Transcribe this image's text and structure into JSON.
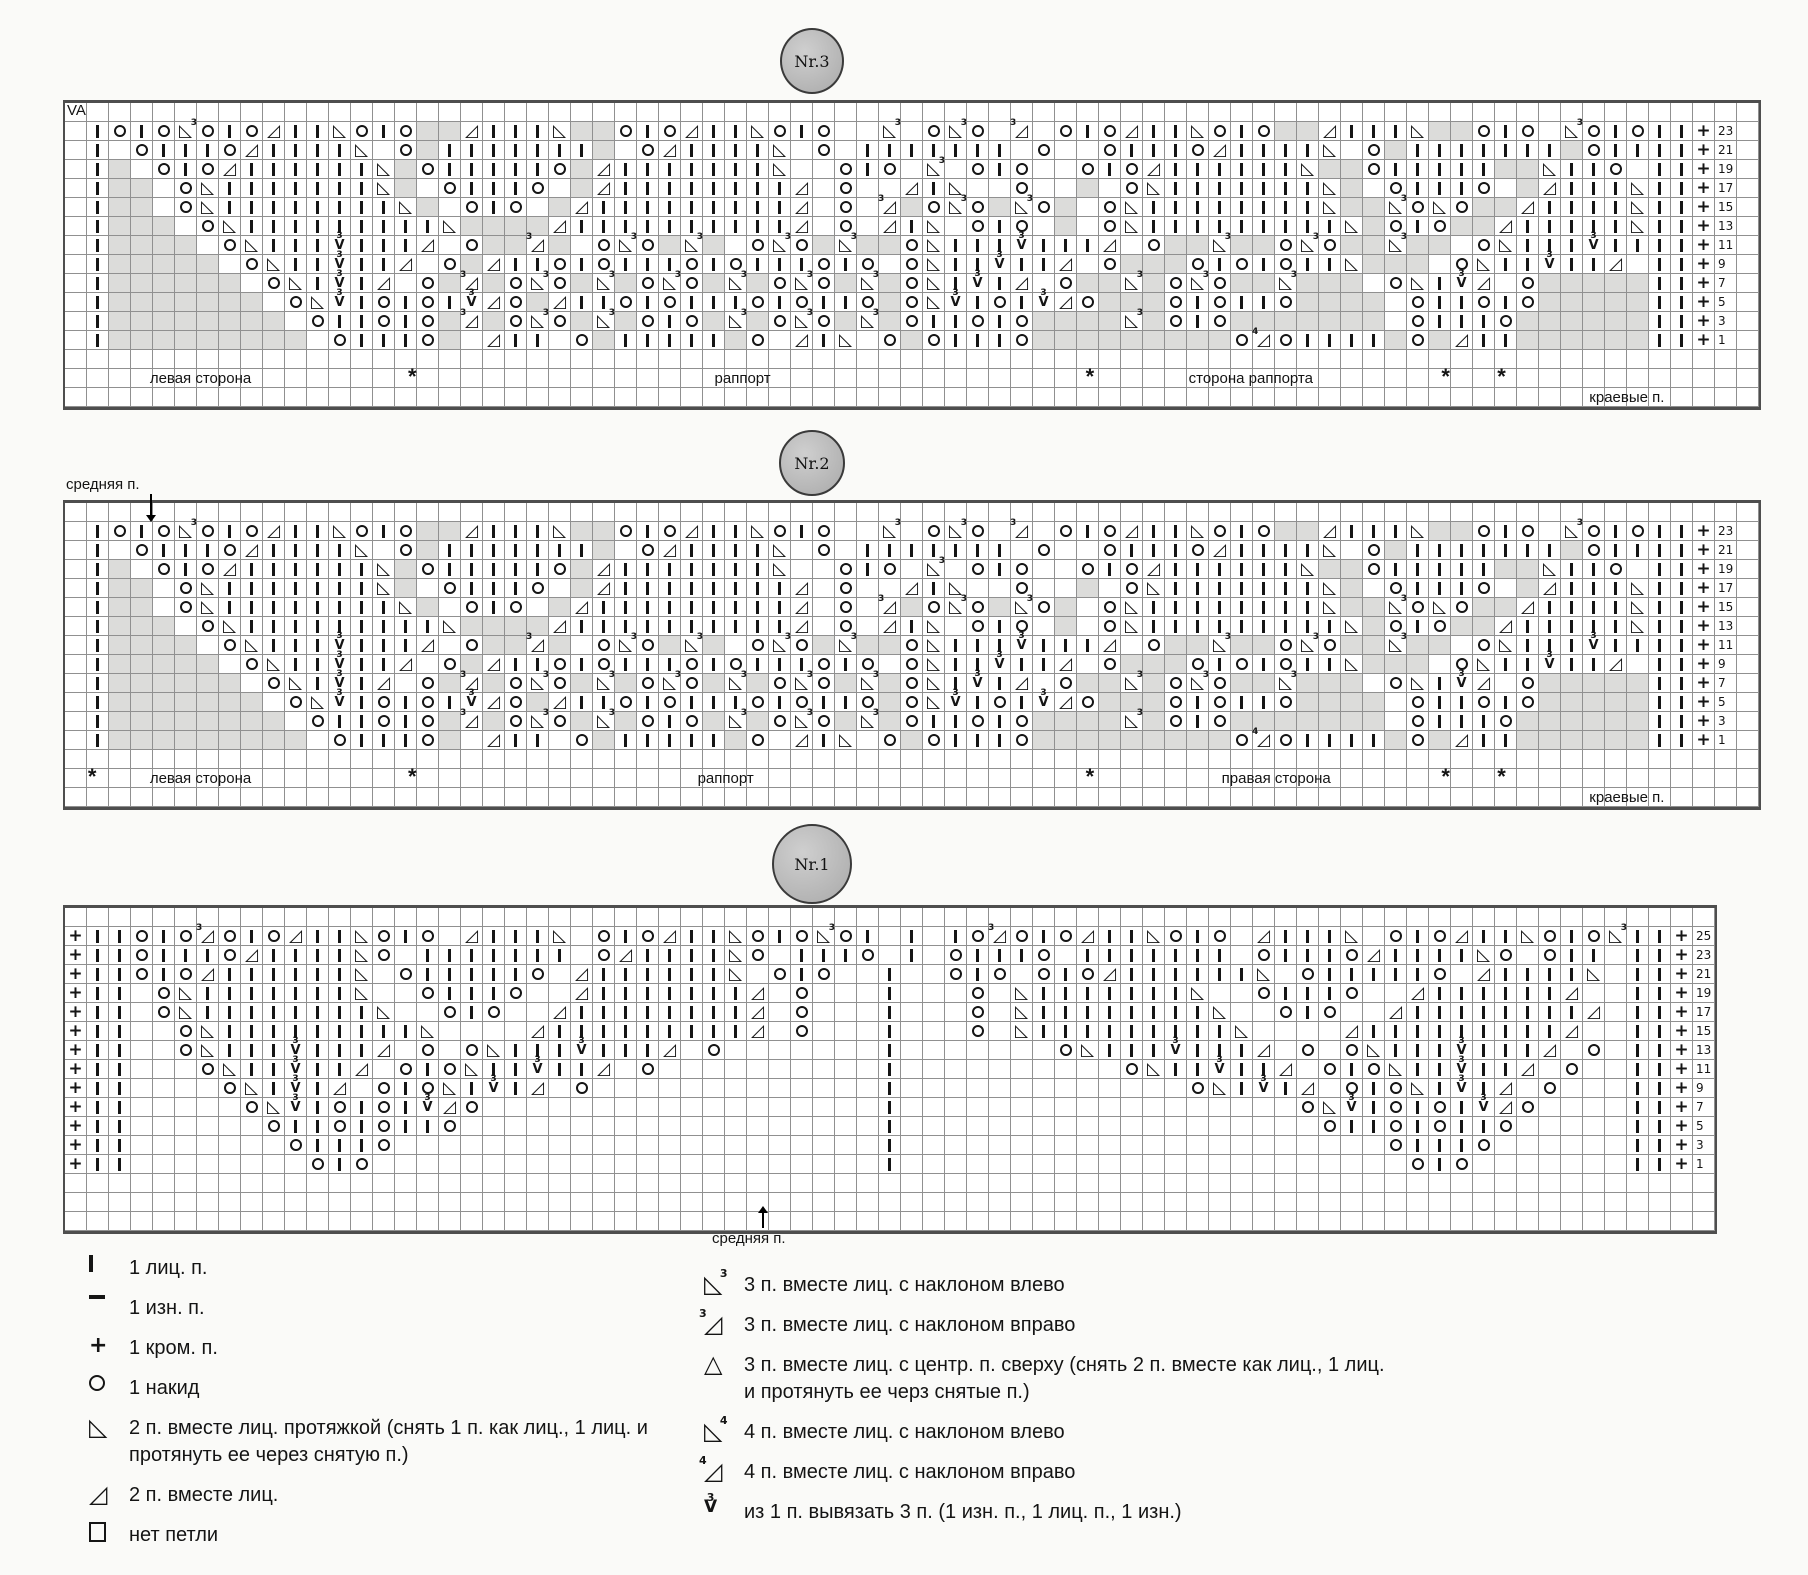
{
  "page": {
    "background": "#fafaf8",
    "grid_line_color": "#909090",
    "shade_color": "#dcdcda",
    "ink_color": "#151515"
  },
  "charts": [
    {
      "id": "nr3",
      "badge": "Nr.3",
      "corner_note": "VA",
      "left_edge": ".I",
      "right_edge": "II",
      "width_cells": 70,
      "trailing_blank_cols": 1,
      "rows": [
        {
          "n": 23,
          "mid": "OIOEOIORIILOIO##RIIIL##OIORIILOIO..E.OEO.Z.OIORIILOIO##RIIIL##OIO.EOIO"
        },
        {
          "n": 21,
          "mid": ".OIIIORIIIIL.O#IIIIIII#.ORIIIIL.O.IIIIIII.O..OIIIORIIIIL.O#IIIIIII#OII"
        },
        {
          "n": 19,
          "mid": "#.OIORIIIIIIL#OIIIIIO#RIIIIIIIL..OIO.E.OIO..OIORIIIIIIL##OIIIII##LIIO."
        },
        {
          "n": 17,
          "mid": "##.OLIIIIIIIL#.OIIIO.#RIIIIIIIIR.O..RIL..O..#.OLIIIIIIIL#.OIIIO.#RIIIL"
        },
        {
          "n": 15,
          "mid": "##.OLIIIIIIIIL#.OIO.#RIIIIIIIIIR.O.Z#OEO#EO#.OLIIIIIIIIL##EOLO##RIIIIL"
        },
        {
          "n": 13,
          "mid": "###.OLIIIIIIIIIL####RIIIIIIIIIIR.O.RIL.OIO.#.OLIIIIIIIIIL#OIO##RIIIIIL"
        },
        {
          "n": 11,
          "mid": "####.OLIIIVIIIR.O##Z#.OEO#E#.OEO#E##OLIIIVIIIR.O##E##OEO##E##.OLIIIVII"
        },
        {
          "n": 9,
          "mid": "#####.OLIIVIIR.O#RIIOIOIIIOIOIIIOIO.OLIIVIIR.O###OIOIOIIL###.OLIIVIIR."
        },
        {
          "n": 7,
          "mid": "######.OLIVIR.O#Z#OEO#E#OEO#E#OEO#E#OLIVIR.O##E#OEO##E###.OLIVR.O#####"
        },
        {
          "n": 5,
          "mid": "#######.OLVIOIOIVRO#RIIOIOIIIOIOIIO#OLVIOIVRO###OIOIIO####.OIIOIO#####"
        },
        {
          "n": 3,
          "mid": "########.OIIOIO#Z#OEO#E#OIO#E#OEO#E#OIIOIO####E#OIO#######.OIIIO######"
        },
        {
          "n": 1,
          "mid": "#########.OIIIO#.RII.O#IIIII#O.RIL.O#OIIIO#########OYOIIII#O#RII######"
        }
      ],
      "footer_row1": [
        {
          "t": "левая сторона",
          "x": 8
        },
        {
          "t": "*",
          "x": 20.5
        },
        {
          "t": "раппорт",
          "x": 40
        },
        {
          "t": "*",
          "x": 60.5
        },
        {
          "t": "сторона раппорта",
          "x": 70
        },
        {
          "t": "*",
          "x": 81.5
        },
        {
          "t": "*",
          "x": 84.8
        }
      ],
      "footer_row2": [
        {
          "t": "краевые п.",
          "x": 92.2
        }
      ]
    },
    {
      "id": "nr2",
      "badge": "Nr.2",
      "top_label": "средняя п.",
      "left_edge": ".I",
      "right_edge": "II",
      "width_cells": 70,
      "trailing_blank_cols": 1,
      "rows": [
        {
          "n": 23,
          "mid": "OIOEOIORIILOIO##RIIIL##OIORIILOIO..E.OEO.Z.OIORIILOIO##RIIIL##OIO.EOIO"
        },
        {
          "n": 21,
          "mid": ".OIIIORIIIIL.O#IIIIIII#.ORIIIIL.O.IIIIIII.O..OIIIORIIIIL.O#IIIIIII#OII"
        },
        {
          "n": 19,
          "mid": "#.OIORIIIIIIL#OIIIIIO#RIIIIIIIL..OIO.E.OIO..OIORIIIIIIL##OIIIII##LIIO."
        },
        {
          "n": 17,
          "mid": "##.OLIIIIIIIL#.OIIIO.#RIIIIIIIIR.O..RIL..O..#.OLIIIIIIIL#.OIIIO.#RIIIL"
        },
        {
          "n": 15,
          "mid": "##.OLIIIIIIIIL#.OIO.#RIIIIIIIIIR.O.Z#OEO#EO#.OLIIIIIIIIL##EOLO##RIIIIL"
        },
        {
          "n": 13,
          "mid": "###.OLIIIIIIIIIL####RIIIIIIIIIIR.O.RIL.OIO.#.OLIIIIIIIIIL#OIO##RIIIIIL"
        },
        {
          "n": 11,
          "mid": "####.OLIIIVIIIR.O##Z#.OEO#E#.OEO#E##OLIIIVIIIR.O##E##OEO##E##.OLIIIVII"
        },
        {
          "n": 9,
          "mid": "#####.OLIIVIIR.O#RIIOIOIIIOIOIIIOIO.OLIIVIIR.O###OIOIOIIL###.OLIIVIIR."
        },
        {
          "n": 7,
          "mid": "######.OLIVIR.O#Z#OEO#E#OEO#E#OEO#E#OLIVIR.O##E#OEO##E###.OLIVR.O#####"
        },
        {
          "n": 5,
          "mid": "#######.OLVIOIOIVRO#RIIOIOIIIOIOIIO#OLVIOIVRO###OIOIIO####.OIIOIO#####"
        },
        {
          "n": 3,
          "mid": "########.OIIOIO#Z#OEO#E#OIO#E#OEO#E#OIIOIO####E#OIO#######.OIIIO######"
        },
        {
          "n": 1,
          "mid": "#########.OIIIO#.RII.O#IIIII#O.RIL.O#OIIIO#########OYOIIII#O#RII######"
        }
      ],
      "footer_row1": [
        {
          "t": "*",
          "x": 1.6
        },
        {
          "t": "левая сторона",
          "x": 8
        },
        {
          "t": "*",
          "x": 20.5
        },
        {
          "t": "раппорт",
          "x": 39
        },
        {
          "t": "*",
          "x": 60.5
        },
        {
          "t": "правая сторона",
          "x": 71.5
        },
        {
          "t": "*",
          "x": 81.5
        },
        {
          "t": "*",
          "x": 84.8
        }
      ],
      "footer_row2": [
        {
          "t": "краевые п.",
          "x": 92.2
        }
      ]
    },
    {
      "id": "nr1",
      "badge": "Nr.1",
      "bottom_label": "средняя п.",
      "left_edge": "+II",
      "right_edge": "II",
      "width_cells": 68,
      "trailing_blank_cols": 0,
      "rows": [
        {
          "n": 25,
          "mid": "OIOZOIORIILOIO.RIIIL.OIORIILOIOEOI.I.IOZOIORIILOIO.RIIIL.OIORIILOIOE"
        },
        {
          "n": 23,
          "mid": "OIIIORIIIILO.IIIIIII.ORIIIILO.IIIO.I.OIIIO.IIIIIII.OIIIORIIIILO.OII."
        },
        {
          "n": 21,
          "mid": "OIORIIIIIIL.OIIIIIO.RIIIIIIL.OIO..I..OIO.OIORIIIIIIL.OIIIIIO.RIIIIL."
        },
        {
          "n": 19,
          "mid": ".OLIIIIIIIL..OIIIO..RIIIIIIIR.O...I...O.LIIIIIIIL..OIIIO..RIIIIIIR.."
        },
        {
          "n": 17,
          "mid": ".OLIIIIIIIIL..OIO..RIIIIIIIIR.O...I...O.LIIIIIIIIL..OIO..RIIIIIIIIR."
        },
        {
          "n": 15,
          "mid": "..OLIIIIIIIIIL....RIIIIIIIIIR.O...I...O.LIIIIIIIIIL....RIIIIIIIIIR.."
        },
        {
          "n": 13,
          "mid": "..OLIIIVIIIR.O.OLIIIVIIIR.O.......I.......OLIIIVIIIR.O.OLIIIVIIIR.O"
        },
        {
          "n": 11,
          "mid": "...OLIIVIIR.OIOLIIVIIR.O..........I..........OLIIVIIR.OIOLIIVIIR.O.."
        },
        {
          "n": 9,
          "mid": "....OLIVIR.OIOLIVIR.O.............I.............OLIVIR.OIOLIVIR.O..."
        },
        {
          "n": 7,
          "mid": ".....OLVIOIOIVRO..................I..................OLVIOIOIVRO...."
        },
        {
          "n": 5,
          "mid": "......OIIOIOIIO...................I...................OIIOIOIIO....."
        },
        {
          "n": 3,
          "mid": ".......OIIIO......................I......................OIIIO......"
        },
        {
          "n": 1,
          "mid": "........OIO.......................I.......................OIO......."
        }
      ],
      "footer_row1": [],
      "footer_row2": []
    }
  ],
  "legend": {
    "left_column": [
      {
        "sym": "I",
        "name": "knit-stitch-symbol",
        "label": "1 лиц. п."
      },
      {
        "sym": "-",
        "name": "purl-stitch-symbol",
        "label": "1 изн. п."
      },
      {
        "sym": "+",
        "name": "edge-stitch-symbol",
        "label": "1 кром. п."
      },
      {
        "sym": "O",
        "name": "yarn-over-symbol",
        "label": "1 накид"
      },
      {
        "sym": "L",
        "name": "ssk-symbol",
        "label": "2 п. вместе лиц. протяжкой (снять 1 п. как лиц., 1 лиц. и протянуть ее через снятую п.)"
      },
      {
        "sym": "R",
        "name": "k2tog-symbol",
        "label": "2 п. вместе лиц."
      },
      {
        "sym": "N",
        "name": "no-stitch-symbol",
        "label": "нет петли"
      }
    ],
    "right_column": [
      {
        "sym": "E",
        "name": "k3tog-left-symbol",
        "label": "3 п. вместе лиц. с наклоном влево"
      },
      {
        "sym": "Z",
        "name": "k3tog-right-symbol",
        "label": "3 п. вместе лиц. с наклоном вправо"
      },
      {
        "sym": "C",
        "name": "centered-double-decrease-symbol",
        "label": "3 п. вместе лиц. с центр. п. сверху (снять 2 п. вместе как лиц., 1 лиц. и протянуть ее черз снятые п.)"
      },
      {
        "sym": "F",
        "name": "k4tog-left-symbol",
        "label": "4 п. вместе лиц. с наклоном влево"
      },
      {
        "sym": "Y",
        "name": "k4tog-right-symbol",
        "label": "4 п. вместе лиц. с наклоном вправо"
      },
      {
        "sym": "V",
        "name": "make-3-from-1-symbol",
        "label": "из 1 п. вывязать 3 п. (1 изн. п., 1 лиц. п., 1 изн.)"
      }
    ]
  }
}
